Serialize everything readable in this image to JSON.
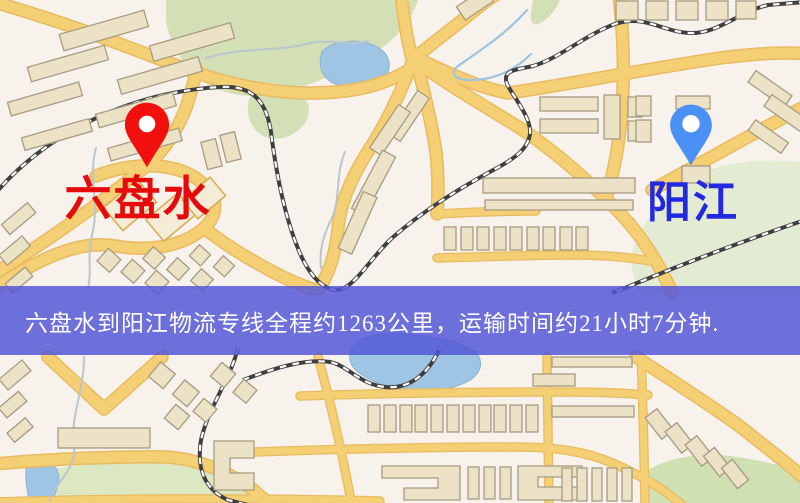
{
  "origin": {
    "name": "六盘水",
    "label_color": "#e60b0b",
    "pin_color": "#f2100e"
  },
  "destination": {
    "name": "阳江",
    "label_color": "#2329e0",
    "pin_color": "#4b90f4"
  },
  "banner": {
    "text": "六盘水到阳江物流专线全程约1263公里，运输时间约21小时7分钟.",
    "background": "rgba(82,86,214,0.84)",
    "text_color": "#ffffff"
  },
  "map": {
    "colors": {
      "background": "#f7f2ec",
      "road": "#f5cf74",
      "road_casing": "#e9bb60",
      "park": "#d3e0b5",
      "park_pale": "#e3ecd3",
      "water": "#9ec6e4",
      "building": "#ece2c6",
      "building_outline": "#a79b81",
      "railway": "#3f3f3f"
    }
  }
}
